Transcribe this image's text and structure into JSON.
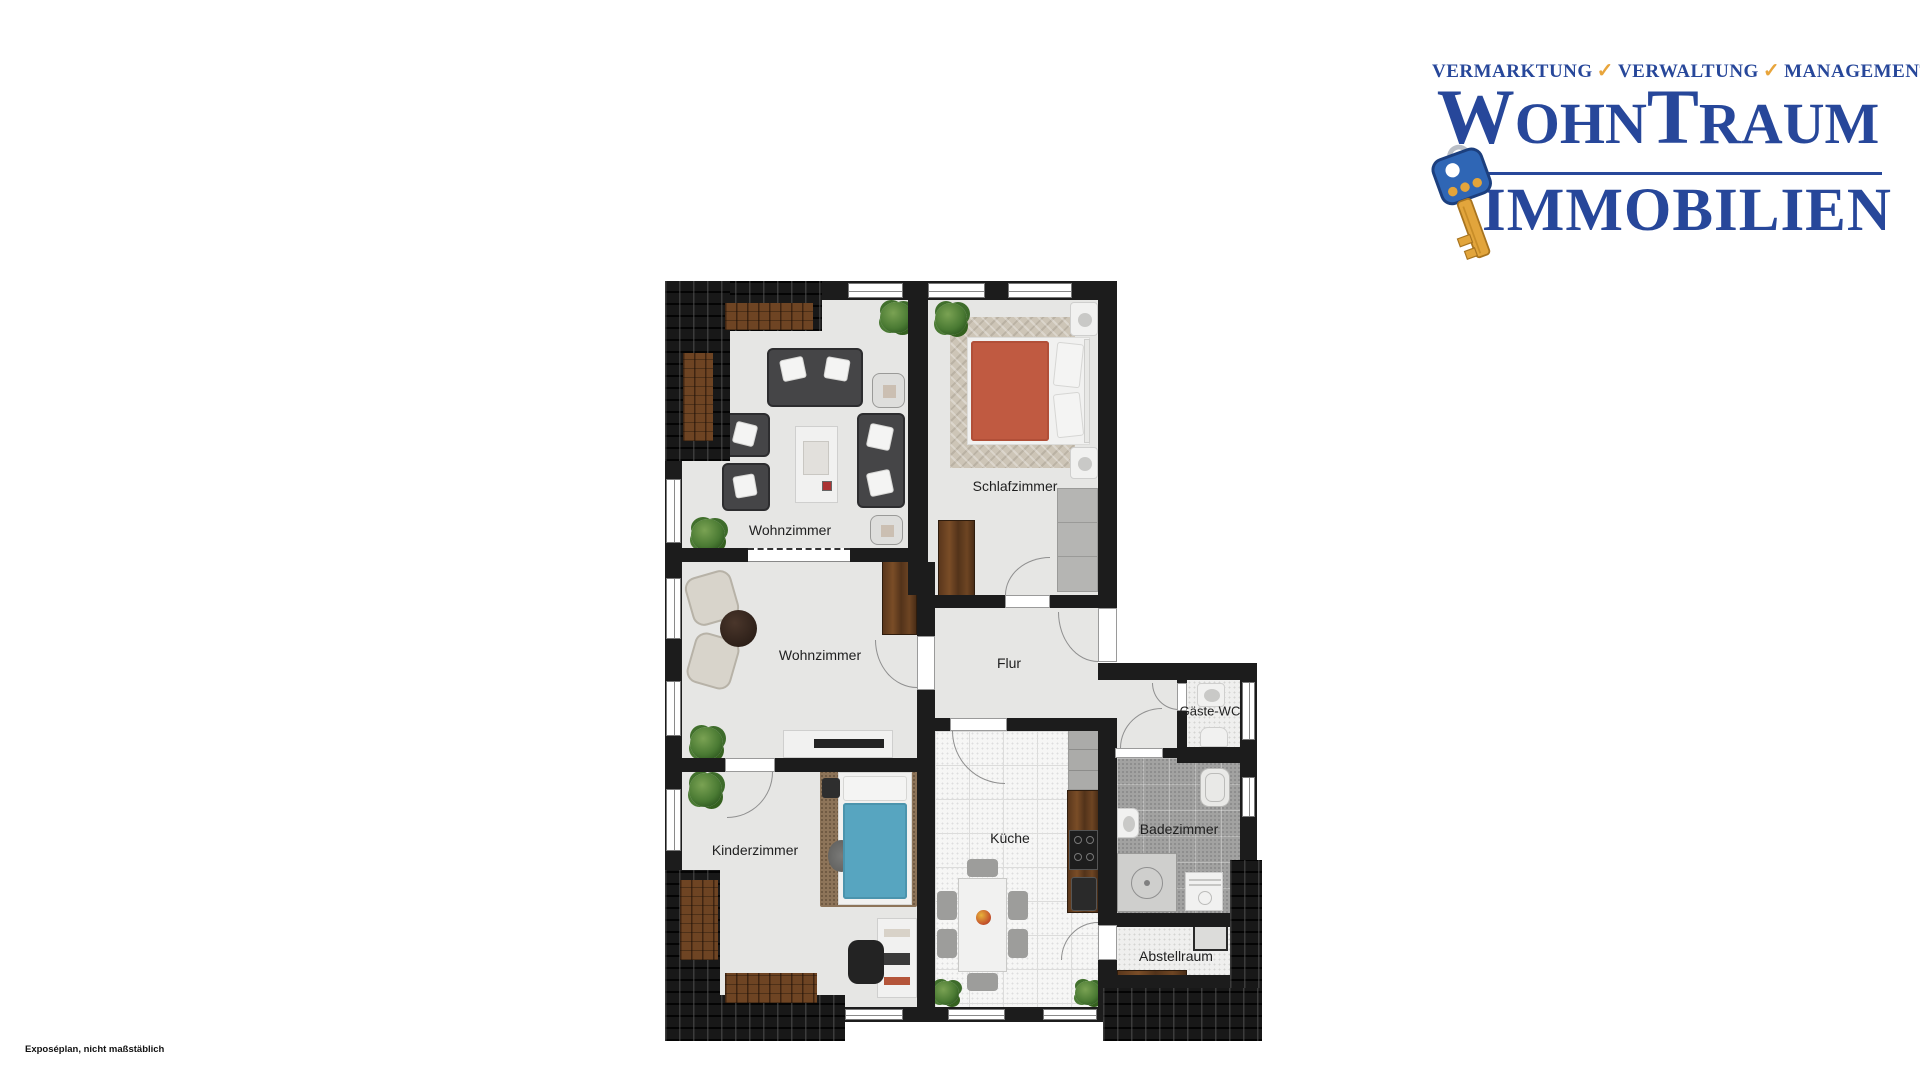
{
  "logo": {
    "tagline": {
      "items": [
        "VERMARKTUNG",
        "VERWALTUNG",
        "MANAGEMENT"
      ],
      "check": "✓"
    },
    "brand": {
      "w": "W",
      "ohn": "OHN",
      "t": "T",
      "raum": "RAUM",
      "line2": "IMMOBILIEN"
    },
    "colors": {
      "brand_blue": "#27479a",
      "check_gold": "#e8a53c"
    }
  },
  "floorplan": {
    "rooms": [
      {
        "id": "wohnzimmer-top",
        "label": "Wohnzimmer"
      },
      {
        "id": "schlafzimmer",
        "label": "Schlafzimmer"
      },
      {
        "id": "wohnzimmer-mitte",
        "label": "Wohnzimmer"
      },
      {
        "id": "flur",
        "label": "Flur"
      },
      {
        "id": "gaeste-wc",
        "label": "Gäste-WC"
      },
      {
        "id": "kinderzimmer",
        "label": "Kinderzimmer"
      },
      {
        "id": "kueche",
        "label": "Küche"
      },
      {
        "id": "badezimmer",
        "label": "Badezimmer"
      },
      {
        "id": "abstellraum",
        "label": "Abstellraum"
      }
    ]
  },
  "footer": {
    "note": "Exposéplan, nicht maßstäblich"
  }
}
